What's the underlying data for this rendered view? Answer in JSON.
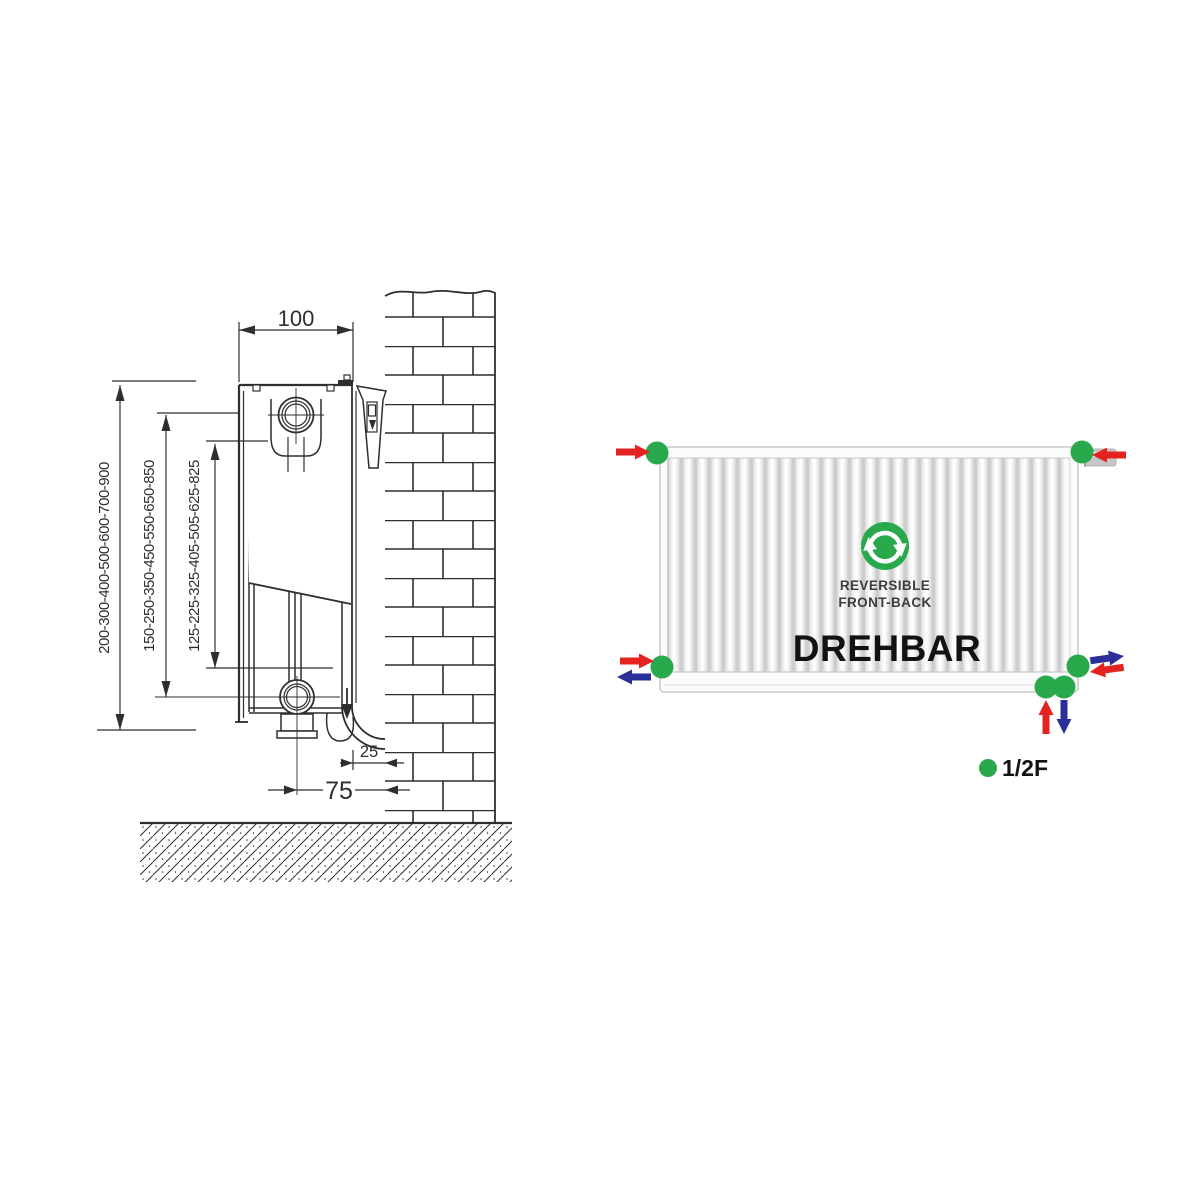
{
  "colors": {
    "line": "#2e2e2e",
    "green": "#2aa84c",
    "red": "#e42320",
    "blue": "#2b2f98"
  },
  "installation_diagram": {
    "depth_label": "100",
    "height_labels": {
      "outer": "200-300-400-500-600-700-900",
      "middle": "150-250-350-450-550-650-850",
      "inner": "125-225-325-405-505-625-825"
    },
    "wall_gap_label": "25",
    "pipe_offset_label": "75"
  },
  "front_view": {
    "badge": {
      "line1": "REVERSIBLE",
      "line2": "FRONT-BACK"
    },
    "title": "DREHBAR",
    "legend": {
      "label": "1/2F"
    }
  },
  "icons": {
    "center_icon": "cycle-arrows-icon",
    "connection_marker": "green-dot",
    "flow_in": "red-arrow",
    "flow_out": "blue-arrow"
  }
}
